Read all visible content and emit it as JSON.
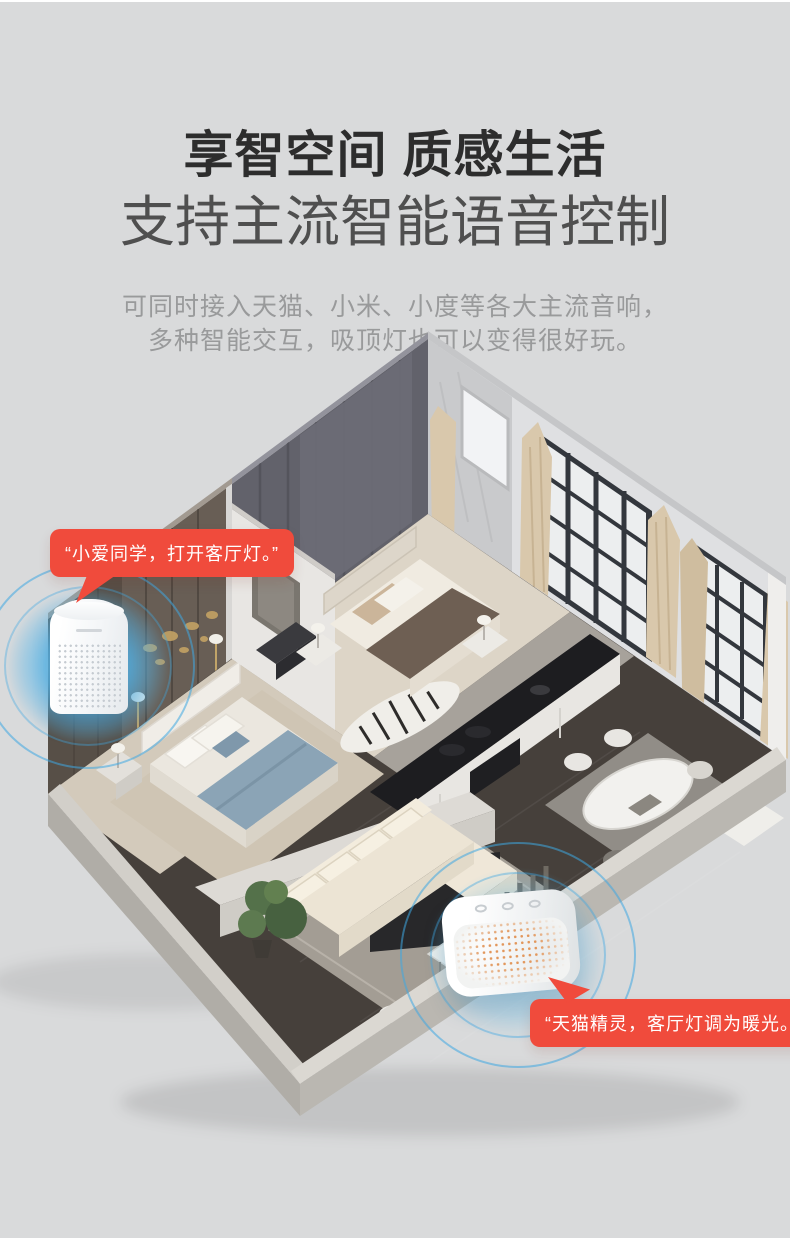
{
  "header": {
    "title": "享智空间 质感生活",
    "subtitle": "支持主流智能语音控制",
    "description": [
      "可同时接入天猫、小米、小度等各大主流音响，",
      "多种智能交互，吸顶灯也可以变得很好玩。"
    ]
  },
  "speech_bubbles": {
    "xiaoai": "“小爱同学，打开客厅灯。”",
    "tmall_genie": "“天猫精灵，客厅灯调为暖光。”"
  },
  "colors": {
    "panel_background": "#d9dadb",
    "title_text": "#2d2d2d",
    "subtitle_text": "#4f4f4f",
    "description_text": "#999a9b",
    "bubble_red": "#f04b3c",
    "bubble_text": "#ffffff",
    "glow_blue": "#58b6e9"
  }
}
